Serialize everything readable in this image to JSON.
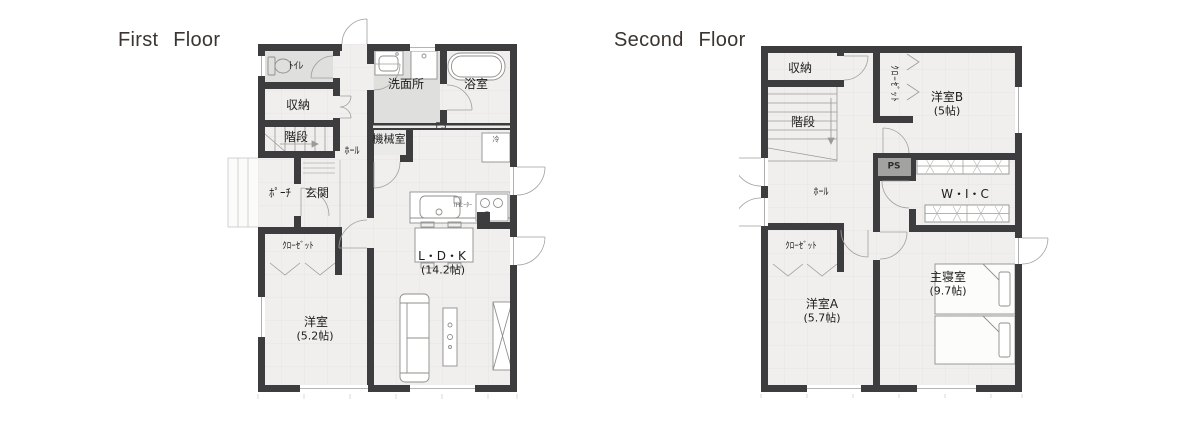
{
  "titles": {
    "first": "First Floor",
    "second": "Second Floor"
  },
  "floor1": {
    "toilet": "ﾄｲﾚ",
    "storage": "収納",
    "stairs": "階段",
    "hall": "ﾎｰﾙ",
    "machine_room": "機械室",
    "washroom": "洗面所",
    "bathroom": "浴室",
    "ps": "PS",
    "porch": "ﾎﾟｰﾁ",
    "entrance": "玄関",
    "closet": "ｸﾛｰｾﾞｯﾄ",
    "western_room": "洋室",
    "western_room_size": "(5.2帖)",
    "ldk": "L・D・K",
    "ldk_size": "(14.2帖)",
    "fridge": "冷",
    "ih_heater": "IHﾋｰﾀｰ"
  },
  "floor2": {
    "storage": "収納",
    "stairs": "階段",
    "closet_b": "ｸﾛｰｾﾞｯﾄ",
    "western_b": "洋室B",
    "western_b_size": "(5帖)",
    "ps": "PS",
    "hall": "ﾎｰﾙ",
    "wic": "W・I・C",
    "closet_a": "ｸﾛｰｾﾞｯﾄ",
    "western_a": "洋室A",
    "western_a_size": "(5.7帖)",
    "master": "主寝室",
    "master_size": "(9.7帖)"
  },
  "colors": {
    "wall": "#3d3d3f",
    "floor": "#f0efed",
    "shaded_room": "#dfdfdd",
    "machine_shade": "#eaeae8",
    "grid": "#e3e3e1",
    "fixture_stroke": "#8f8f8d",
    "door_arc": "#a0a09e",
    "ps_fill": "#a2a2a0",
    "title_text": "#3b3430",
    "label_text": "#1d1d1d"
  }
}
